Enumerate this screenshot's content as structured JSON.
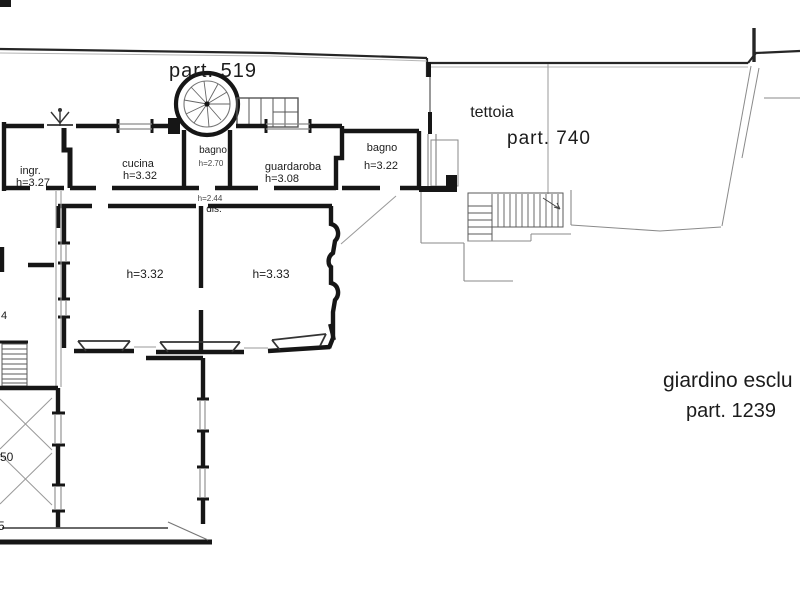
{
  "document": {
    "type": "architectural floor plan",
    "background": "#ffffff",
    "wall_ink": "#161616",
    "thin_line": "#8a8a8a",
    "text_ink": "#1c1c1c"
  },
  "parcels": {
    "parcel_519": "part. 519",
    "parcel_740": "part. 740",
    "parcel_1239": "part. 1239",
    "tettoia": "tettoia",
    "giardino": "giardino esclu"
  },
  "rooms": {
    "ingresso": {
      "name": "ingr.",
      "height": "h=3.27"
    },
    "cucina": {
      "name": "cucina",
      "height": "h=3.32"
    },
    "bagno_scala": {
      "name": "bagno",
      "height": "h=2.70"
    },
    "guardaroba": {
      "name": "guardaroba",
      "height": "h=3.08"
    },
    "bagno": {
      "name": "bagno",
      "height": "h=3.22"
    },
    "disimpegno": {
      "name": "dis.",
      "height": "h=2.44"
    },
    "camera_1": {
      "height": "h=3.32"
    },
    "camera_2": {
      "height": "h=3.33"
    }
  },
  "edge_labels": {
    "left_mid": "4",
    "left_low": "50",
    "left_bottom": "5"
  }
}
